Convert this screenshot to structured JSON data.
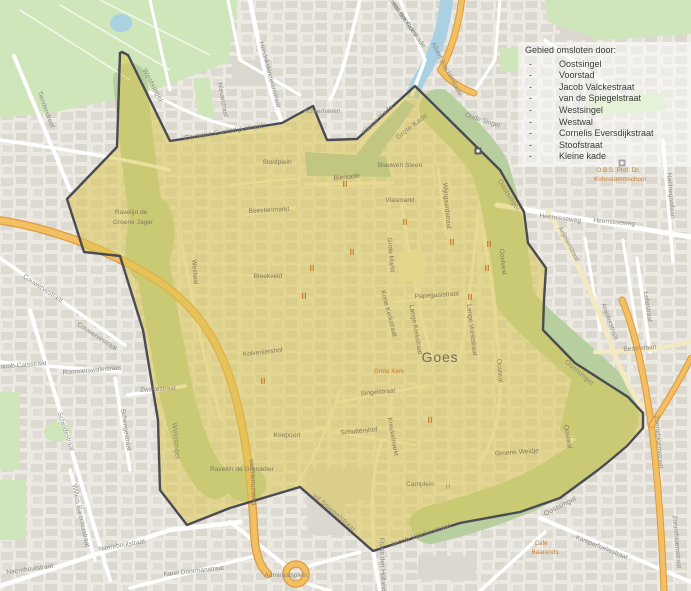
{
  "map": {
    "city_label": "Goes",
    "legend": {
      "title": "Gebied omsloten door:",
      "bullet": "-",
      "items": [
        "Oostsingel",
        "Voorstad",
        "Jacob Valckestraat",
        "van de Spiegelstraat",
        "Westsingel",
        "Westwal",
        "Cornelis Eversdijkstraat",
        "Stoofstraat",
        "Kleine kade"
      ]
    },
    "colors": {
      "bg": "#eceae3",
      "building": "#dbd8d0",
      "park": "#cfe6ba",
      "moat": "#b7cf9f",
      "water": "#a9d1e2",
      "harbor": "#a3c6bd",
      "road_white": "#ffffff",
      "road_orange": "#f2bf62",
      "road_casing": "#dd9a3f",
      "highlight_fill": "rgba(219,199,80,0.55)",
      "boundary": "#4b4b53",
      "label_out": "#8b8b82",
      "label_in": "#84795a",
      "poi": "#c97f2e",
      "city": "#6e6e62",
      "legend_text": "#3b3b38"
    },
    "labels": [
      {
        "t": "Tiendendreef",
        "x": 44,
        "y": 110,
        "r": 70
      },
      {
        "t": "Couwervestraat",
        "x": 42,
        "y": 290,
        "r": 33
      },
      {
        "t": "Couwervestraat",
        "x": 96,
        "y": 338,
        "r": 33
      },
      {
        "t": "Jacob Catsstraat",
        "x": 22,
        "y": 367,
        "r": -4
      },
      {
        "t": "Rommerswalestraat",
        "x": 92,
        "y": 372,
        "r": -5
      },
      {
        "t": "Scheldestraat",
        "x": 64,
        "y": 432,
        "r": 72
      },
      {
        "t": "Schengestraat",
        "x": 124,
        "y": 430,
        "r": 82
      },
      {
        "t": "Zwakestraat",
        "x": 158,
        "y": 391,
        "r": -3
      },
      {
        "t": "Willem Barentszstraat",
        "x": 79,
        "y": 516,
        "r": 78
      },
      {
        "t": "Naereboutstraat",
        "x": 122,
        "y": 547,
        "r": -10
      },
      {
        "t": "Naereboutstraat",
        "x": 30,
        "y": 571,
        "r": -8
      },
      {
        "t": "Karel Doormanstraat",
        "x": 194,
        "y": 573,
        "r": -6
      },
      {
        "t": "Nieuwstraat",
        "x": 221,
        "y": 100,
        "r": 80
      },
      {
        "t": "Hendrikskinderenstraat",
        "x": 268,
        "y": 75,
        "r": 75
      },
      {
        "t": "Achterhaven",
        "x": 322,
        "y": 113
      },
      {
        "t": "Joannes Antonides",
        "x": 399,
        "y": 14,
        "r": 55
      },
      {
        "t": "van der Goeskade",
        "x": 407,
        "y": 26,
        "r": 55
      },
      {
        "t": "Albert Joachimikade",
        "x": 445,
        "y": 70,
        "r": 62
      },
      {
        "t": "Oude Singel",
        "x": 482,
        "y": 122,
        "r": 18
      },
      {
        "t": "Heernisseweg",
        "x": 560,
        "y": 220,
        "r": 7
      },
      {
        "t": "Heernisseweg",
        "x": 614,
        "y": 224,
        "r": 5
      },
      {
        "t": "Nachtegaallaan",
        "x": 669,
        "y": 196,
        "r": 85
      },
      {
        "t": "Anjelierstraat",
        "x": 567,
        "y": 245,
        "r": 62
      },
      {
        "t": "Anjelierstraat",
        "x": 608,
        "y": 322,
        "r": 70
      },
      {
        "t": "Leliestraat",
        "x": 646,
        "y": 307,
        "r": 82
      },
      {
        "t": "Beatrixlaan",
        "x": 640,
        "y": 350,
        "r": -4
      },
      {
        "t": "Zonnebloemstraat",
        "x": 657,
        "y": 442,
        "r": 85
      },
      {
        "t": "Zonnebloemstraat",
        "x": 675,
        "y": 542,
        "r": 85
      },
      {
        "t": "Kamperfoeliestraat",
        "x": 601,
        "y": 549,
        "r": 22
      },
      {
        "t": "Admiraalsplein",
        "x": 286,
        "y": 577
      },
      {
        "t": "Frans den Hollanderlaan",
        "x": 381,
        "y": 574,
        "r": 88
      },
      {
        "t": "Goes",
        "x": 440,
        "y": 362,
        "k": "city"
      },
      {
        "t": "Grote Markt",
        "x": 389,
        "y": 255,
        "r": 85,
        "k": "in"
      },
      {
        "t": "Lange Kerkstraat",
        "x": 414,
        "y": 330,
        "r": 80,
        "k": "in"
      },
      {
        "t": "Lange Vorststraat",
        "x": 470,
        "y": 330,
        "r": 83,
        "k": "in"
      },
      {
        "t": "Papegaaistraat",
        "x": 437,
        "y": 297,
        "r": -4,
        "k": "in"
      },
      {
        "t": "Korte Kerkstraat",
        "x": 387,
        "y": 314,
        "r": 75,
        "k": "in"
      },
      {
        "t": "Singelstraat",
        "x": 378,
        "y": 394,
        "r": -5,
        "k": "in"
      },
      {
        "t": "Kreukelmarkt",
        "x": 391,
        "y": 437,
        "r": 80,
        "k": "in"
      },
      {
        "t": "Wijngaardstraat",
        "x": 445,
        "y": 206,
        "r": 85,
        "k": "in"
      },
      {
        "t": "Vlasmarkt",
        "x": 400,
        "y": 202,
        "k": "in"
      },
      {
        "t": "Blauwen Steen",
        "x": 400,
        "y": 167,
        "k": "in"
      },
      {
        "t": "Bierkade",
        "x": 347,
        "y": 179,
        "r": -6,
        "k": "in"
      },
      {
        "t": "Beestenmarkt",
        "x": 269,
        "y": 212,
        "r": -3,
        "k": "in"
      },
      {
        "t": "Stoofplein",
        "x": 277,
        "y": 164,
        "k": "in"
      },
      {
        "t": "Kolveniershof",
        "x": 263,
        "y": 354,
        "r": -6,
        "k": "in"
      },
      {
        "t": "Bleekveld",
        "x": 268,
        "y": 278,
        "k": "in"
      },
      {
        "t": "Westwal",
        "x": 193,
        "y": 272,
        "r": 86,
        "k": "in"
      },
      {
        "t": "Oostvest",
        "x": 501,
        "y": 262,
        "r": 84,
        "k": "in"
      },
      {
        "t": "Oostwal",
        "x": 498,
        "y": 371,
        "r": 86,
        "k": "in"
      },
      {
        "t": "Oostwal",
        "x": 566,
        "y": 437,
        "r": 80,
        "k": "in"
      },
      {
        "t": "Koepoort",
        "x": 287,
        "y": 437,
        "k": "in"
      },
      {
        "t": "Schuttershof",
        "x": 359,
        "y": 433,
        "r": -5,
        "k": "in"
      },
      {
        "t": "Ravelijn de",
        "x": 131,
        "y": 214,
        "k": "in"
      },
      {
        "t": "Groene Jager",
        "x": 133,
        "y": 224,
        "k": "in"
      },
      {
        "t": "Ravelijn de Grenadier",
        "x": 242,
        "y": 471,
        "k": "in"
      },
      {
        "t": "Groene Weidje",
        "x": 517,
        "y": 454,
        "r": -4,
        "k": "in"
      },
      {
        "t": "Camplein",
        "x": 420,
        "y": 486,
        "k": "in"
      },
      {
        "t": "van Hertumweg",
        "x": 251,
        "y": 482,
        "r": 87,
        "k": "in"
      },
      {
        "t": "Westsingel",
        "x": 151,
        "y": 86,
        "r": 62,
        "k": "bnd"
      },
      {
        "t": "Westsingel",
        "x": 174,
        "y": 441,
        "r": 85,
        "k": "bnd"
      },
      {
        "t": "Cornelis Eversdijkstraat",
        "x": 224,
        "y": 134,
        "r": -9,
        "k": "bnd"
      },
      {
        "t": "Kleine Kade",
        "x": 379,
        "y": 121,
        "r": -43,
        "k": "bnd"
      },
      {
        "t": "Grote Kade",
        "x": 413,
        "y": 128,
        "r": -38,
        "k": "bnd"
      },
      {
        "t": "Oostsingel",
        "x": 507,
        "y": 196,
        "r": 58,
        "k": "bnd"
      },
      {
        "t": "Oostsingel",
        "x": 578,
        "y": 374,
        "r": 40,
        "k": "bnd"
      },
      {
        "t": "Oostsingel",
        "x": 561,
        "y": 508,
        "r": -27,
        "k": "bnd"
      },
      {
        "t": "Jacob Valckestraat",
        "x": 421,
        "y": 537,
        "r": -18,
        "k": "bnd"
      },
      {
        "t": "vd Spiegelstraat",
        "x": 333,
        "y": 514,
        "r": 41,
        "k": "bnd"
      },
      {
        "t": "Grote Kerk",
        "x": 389,
        "y": 373,
        "k": "poi"
      },
      {
        "t": "Café",
        "x": 541,
        "y": 545,
        "k": "poi"
      },
      {
        "t": "Baarends",
        "x": 545,
        "y": 554,
        "k": "poi"
      },
      {
        "t": "O.B.S. Prof. Dr.",
        "x": 618,
        "y": 172,
        "k": "poi"
      },
      {
        "t": "Kohnstammschool",
        "x": 620,
        "y": 181,
        "k": "poi"
      },
      {
        "t": "H",
        "x": 448,
        "y": 489,
        "k": "poi",
        "s": 7
      }
    ],
    "poi_icons": {
      "food": [
        [
          345,
          184
        ],
        [
          352,
          252
        ],
        [
          312,
          268
        ],
        [
          304,
          296
        ],
        [
          452,
          242
        ],
        [
          489,
          244
        ],
        [
          487,
          268
        ],
        [
          470,
          297
        ],
        [
          430,
          420
        ],
        [
          263,
          381
        ],
        [
          405,
          222
        ]
      ],
      "building": [
        [
          478,
          151
        ],
        [
          622,
          163
        ]
      ]
    }
  }
}
